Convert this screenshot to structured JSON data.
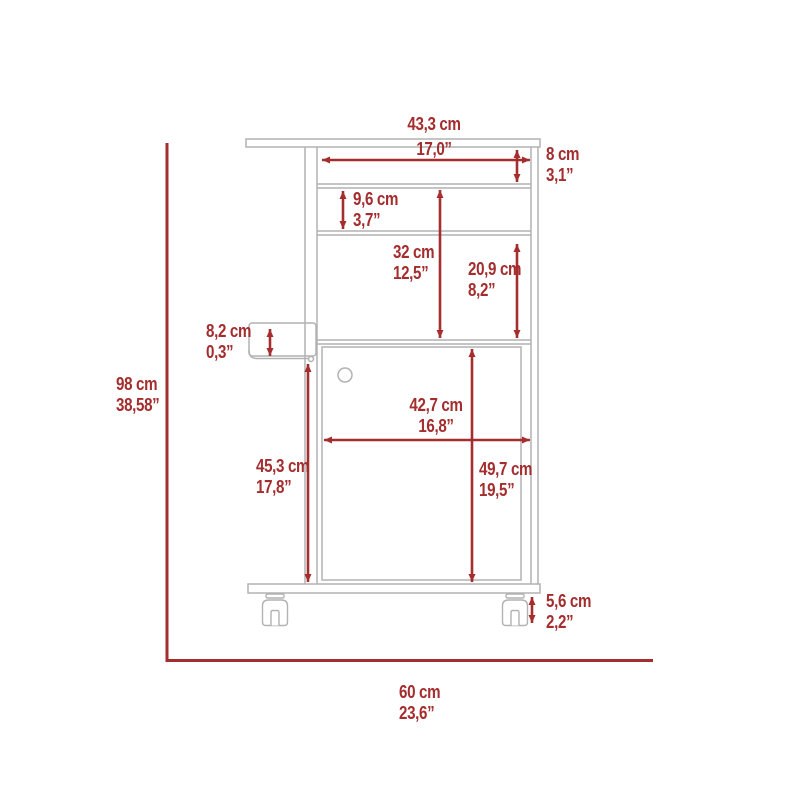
{
  "diagram": {
    "type": "furniture-dimension-drawing",
    "units": "cm / inches"
  },
  "colors": {
    "dimension_red": "#a42d2e",
    "outline_gray": "#b2b2b2",
    "background": "#ffffff"
  },
  "dimensions": {
    "top_width": {
      "cm": "43,3 cm",
      "in": "17,0”"
    },
    "top_opening_height": {
      "cm": "8 cm",
      "in": "3,1”"
    },
    "middle_shelf_height": {
      "cm": "9,6 cm",
      "in": "3,7”"
    },
    "upper_section_height": {
      "cm": "32 cm",
      "in": "12,5”"
    },
    "shelf_opening_height": {
      "cm": "20,9 cm",
      "in": "8,2”"
    },
    "towel_bar_height": {
      "cm": "8,2 cm",
      "in": "0,3”"
    },
    "overall_height": {
      "cm": "98 cm",
      "in": "38,58”"
    },
    "door_width": {
      "cm": "42,7 cm",
      "in": "16,8”"
    },
    "lower_left_height": {
      "cm": "45,3 cm",
      "in": "17,8”"
    },
    "door_height": {
      "cm": "49,7 cm",
      "in": "19,5”"
    },
    "caster_height": {
      "cm": "5,6 cm",
      "in": "2,2”"
    },
    "overall_width": {
      "cm": "60 cm",
      "in": "23,6”"
    }
  }
}
